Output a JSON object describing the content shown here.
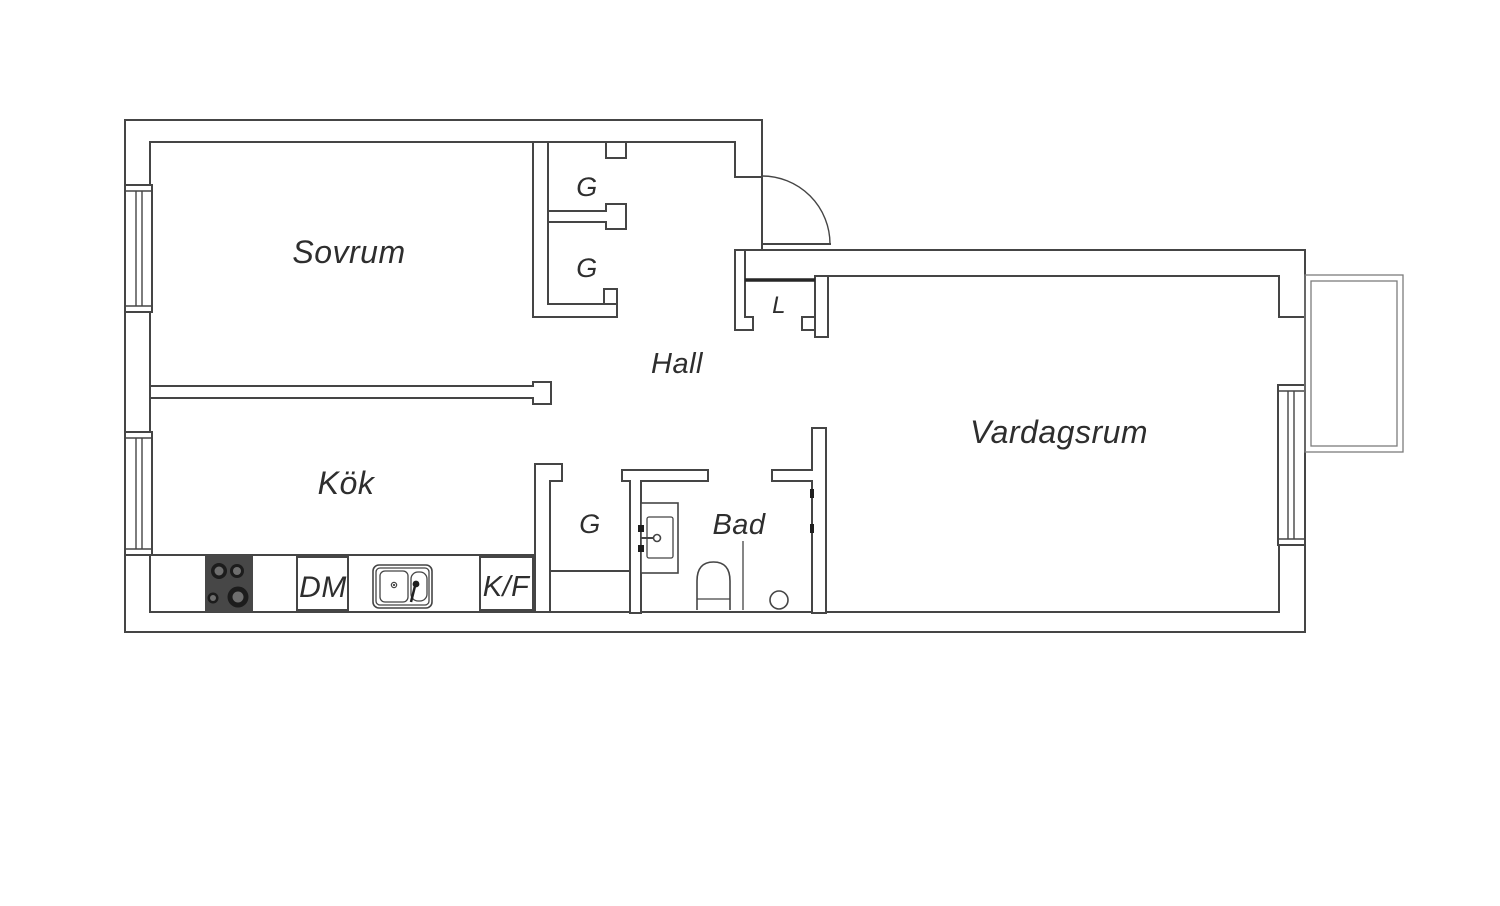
{
  "plan_type": "apartment-floor-plan",
  "rooms": {
    "bedroom": "Sovrum",
    "kitchen": "Kök",
    "hall": "Hall",
    "living_room": "Vardagsrum",
    "bathroom": "Bad"
  },
  "closets": {
    "top_wardrobe_1": "G",
    "top_wardrobe_2": "G",
    "hall_wardrobe": "G",
    "linen_closet": "L"
  },
  "kitchen_appliances": {
    "dishwasher": "DM",
    "fridge_freezer": "K/F"
  },
  "fixtures": [
    "stove-icon",
    "sink-icon",
    "washbasin-icon",
    "toilet-icon",
    "floor-drain-icon",
    "entrance-door-icon",
    "window-icon",
    "balcony-icon"
  ],
  "colors": {
    "wall_line": "#454545",
    "balcony_line": "#7c7c7c",
    "label_text": "#2e2e2e",
    "stove_fill": "#474747",
    "burner_dark": "#1c1c1c",
    "burner_core": "#6e6e6e",
    "closet_top_accent": "#262626",
    "background": "#ffffff"
  }
}
